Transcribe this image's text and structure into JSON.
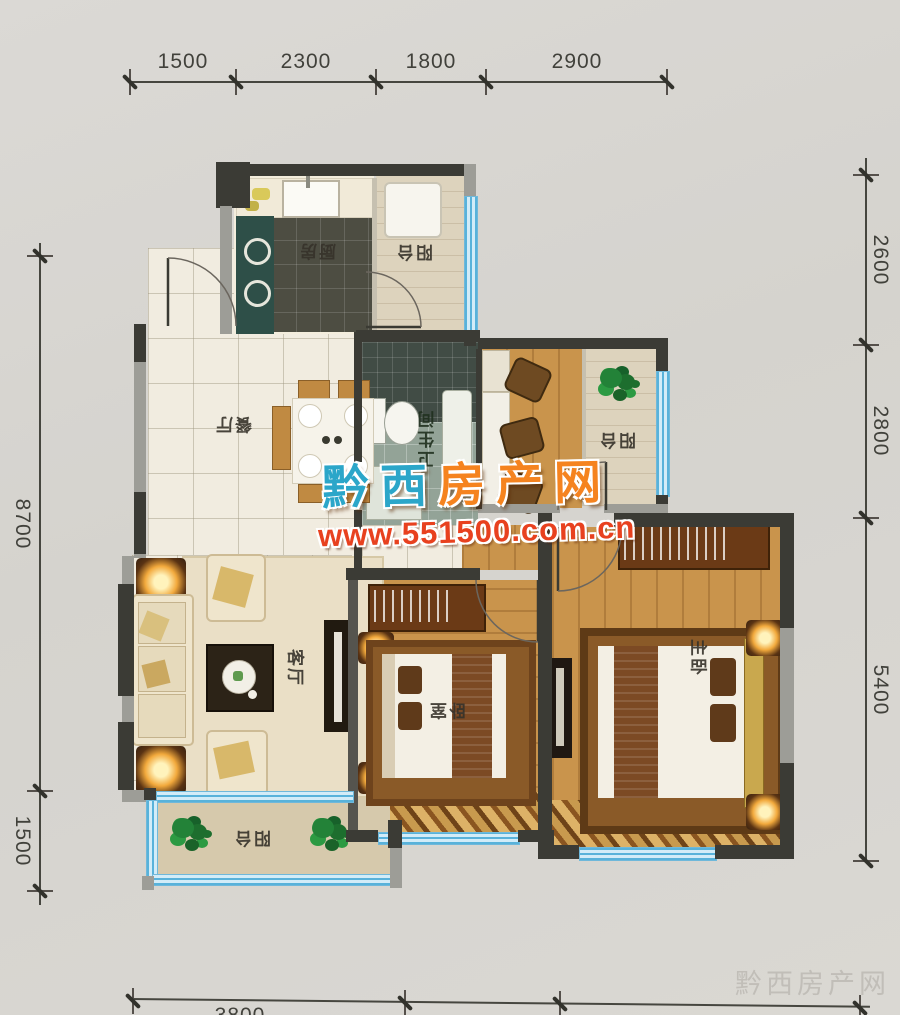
{
  "dimensions": {
    "top": [
      "1500",
      "2300",
      "1800",
      "2900"
    ],
    "right": [
      "2600",
      "2800",
      "5400"
    ],
    "left": [
      "8700",
      "1500"
    ],
    "bottom": [
      "3800"
    ]
  },
  "rooms": {
    "kitchen": "厨房",
    "balcony_top": "阳台",
    "bathroom": "卫生间",
    "balcony_mid": "阳台",
    "dining": "餐厅",
    "living": "客厅",
    "bedroom": "卧室",
    "master": "主卧",
    "balcony_bottom": "阳台"
  },
  "watermark": {
    "brand_blue": "黔西",
    "brand_orange": "房产网",
    "url": "www.551500.com.cn",
    "corner": "黔西房产网"
  },
  "colors": {
    "brand_blue": "#2ba6c9",
    "brand_orange": "#f5831f",
    "url_red": "#e8411f",
    "window_blue": "#58b2da",
    "wood_floor": "#c9944c",
    "wall_dark": "#3b3b35"
  }
}
